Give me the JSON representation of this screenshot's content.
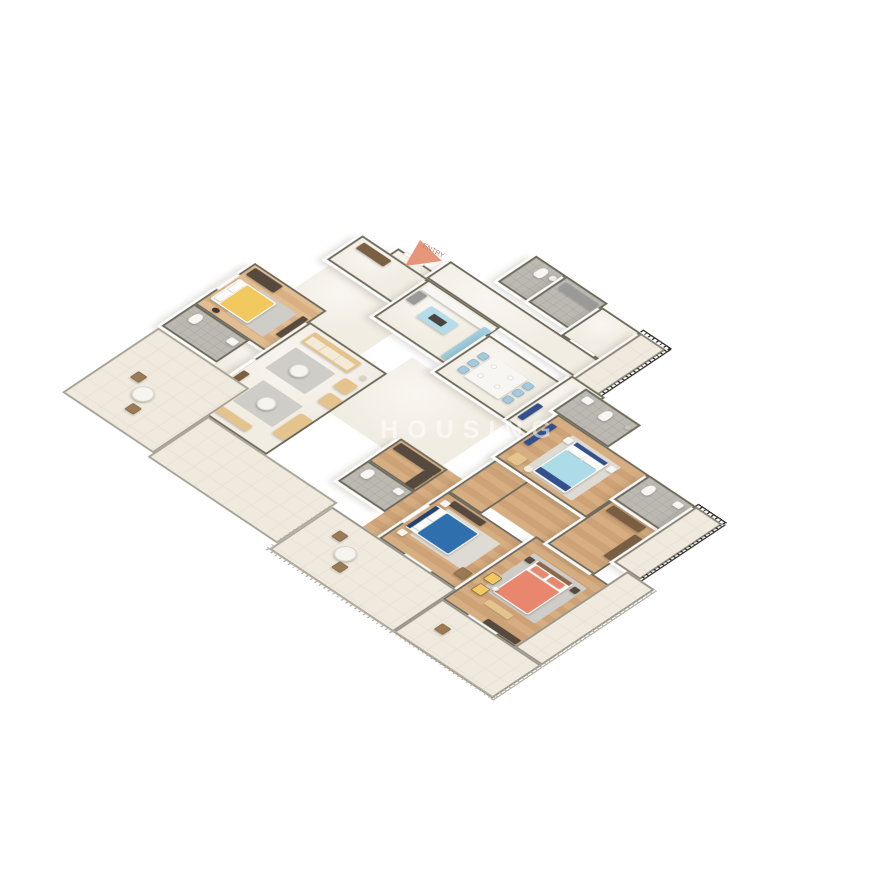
{
  "scene": {
    "type": "isometric-3d-floor-plan",
    "background": "#ffffff"
  },
  "watermark": {
    "text": "HOUSING"
  },
  "entry": {
    "label": "ENTRY"
  },
  "colors": {
    "wallCap": "#6f6b5c",
    "lowWall": "#a8a397",
    "marble": "#f2ede3",
    "woodA": "#d7ae81",
    "woodB": "#cda276",
    "tile": "#bcb9b3",
    "tileLine": "#a8a59f",
    "terrace": "#efe9de",
    "terLine": "#e3dccf",
    "railDark": "#2e2b27",
    "railLight": "#b6b1a5",
    "yellowBed": "#f2c95f",
    "blueBed": "#2f6fad",
    "lightBlueBed": "#aedbe8",
    "navy": "#33508c",
    "coralBed": "#e9876e",
    "sofa": "#e5c38c",
    "cushion": "#f4ead8",
    "woodDark": "#554a3d",
    "woodMid": "#7a5f43",
    "chairBlue": "#a5cade",
    "island": "#b5dcea",
    "counterBlue": "#9fcfe0",
    "applianceGray": "#9a9a98",
    "whiteFurn": "#f7f6f2",
    "rugGray": "#cfcdc8",
    "rugLight": "#dedbd4",
    "chairWood": "#9b7b55",
    "arrow": "#e58b6d",
    "watermarkColor": "rgba(255,255,255,0.55)"
  },
  "rooms": [
    {
      "id": "entry-vestibule",
      "floor": "marble"
    },
    {
      "id": "wc",
      "floor": "tile"
    },
    {
      "id": "utility",
      "floor": "tile"
    },
    {
      "id": "store",
      "floor": "marble"
    },
    {
      "id": "north-lobby",
      "floor": "marble"
    },
    {
      "id": "balcony-northeast",
      "floor": "terrace"
    },
    {
      "id": "foyer",
      "floor": "marble"
    },
    {
      "id": "kitchen",
      "floor": "marble"
    },
    {
      "id": "dining",
      "floor": "marble"
    },
    {
      "id": "corridor-mid",
      "floor": "marble"
    },
    {
      "id": "bedroom-1-yellow",
      "floor": "wood"
    },
    {
      "id": "bathroom-1",
      "floor": "tile"
    },
    {
      "id": "living-room",
      "floor": "marble"
    },
    {
      "id": "terrace-west",
      "floor": "terrace"
    },
    {
      "id": "terrace-southwest",
      "floor": "terrace"
    },
    {
      "id": "walk-in-closet",
      "floor": "wood"
    },
    {
      "id": "bathroom-4",
      "floor": "tile"
    },
    {
      "id": "corridor-south",
      "floor": "wood"
    },
    {
      "id": "bedroom-3-blue",
      "floor": "wood"
    },
    {
      "id": "bedroom-4-coral",
      "floor": "wood"
    },
    {
      "id": "dressing",
      "floor": "wood"
    },
    {
      "id": "bathroom-2",
      "floor": "tile"
    },
    {
      "id": "bedroom-2-lightblue",
      "floor": "wood"
    },
    {
      "id": "bathroom-3",
      "floor": "tile"
    },
    {
      "id": "balcony-east",
      "floor": "terrace"
    },
    {
      "id": "terrace-south-a",
      "floor": "terrace"
    },
    {
      "id": "terrace-south-b",
      "floor": "terrace"
    },
    {
      "id": "terrace-east-strip",
      "floor": "terrace"
    }
  ]
}
